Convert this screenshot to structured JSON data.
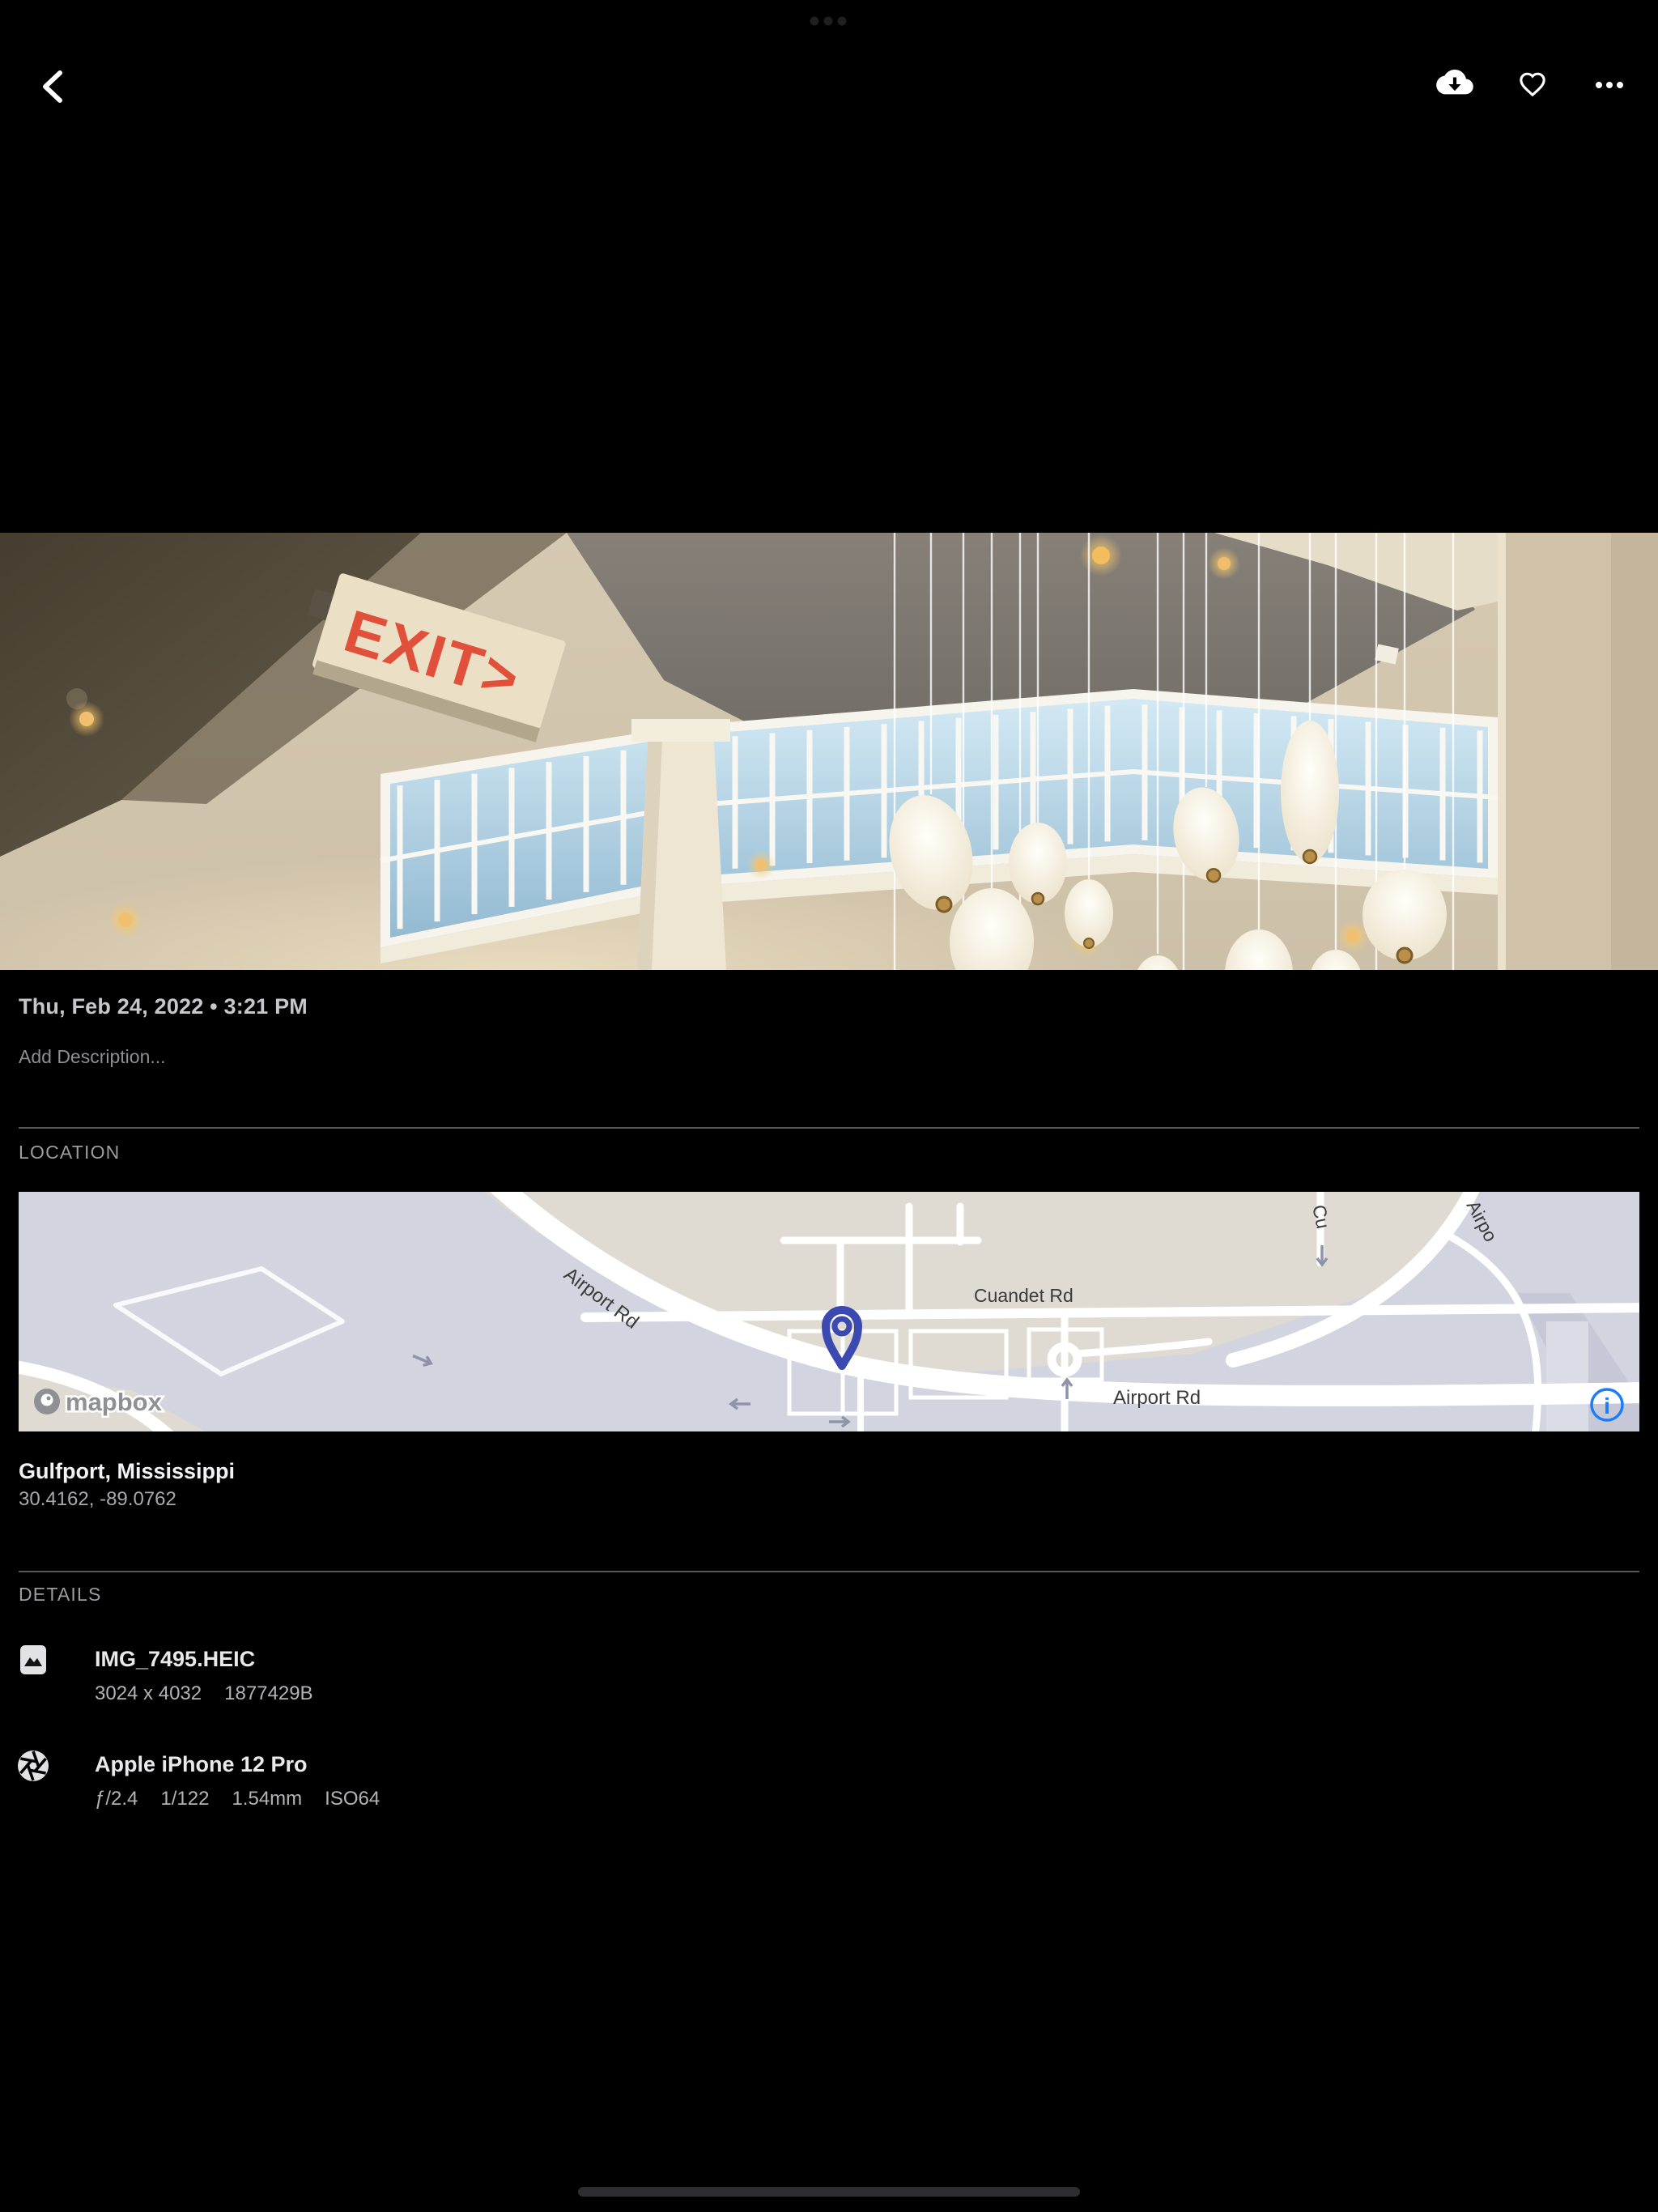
{
  "colors": {
    "background": "#000000",
    "info_blue": "#1d7df6",
    "pin_indigo": "#3a4ab0",
    "exit_red": "#e0503a",
    "map_land": "#dfdbd2",
    "map_water": "#d2d4e0"
  },
  "photo": {
    "exit_sign_text": "EXIT>"
  },
  "info": {
    "datetime": "Thu, Feb 24, 2022 • 3:21 PM",
    "description_placeholder": "Add Description..."
  },
  "location": {
    "header": "LOCATION",
    "place": "Gulfport, Mississippi",
    "coordinates": "30.4162, -89.0762",
    "map": {
      "labels": {
        "airport_rd_upper": "Airport Rd",
        "cuandet_rd": "Cuandet Rd",
        "airport_rd_lower": "Airport Rd",
        "partial_cu": "Cu",
        "partial_airpo": "Airpo"
      },
      "attribution": "mapbox",
      "info_glyph": "i"
    }
  },
  "details": {
    "header": "DETAILS",
    "files": [
      {
        "icon": "image-icon",
        "title": "IMG_7495.HEIC",
        "meta": [
          "3024 x 4032",
          "1877429B"
        ]
      },
      {
        "icon": "aperture-icon",
        "title": "Apple iPhone 12 Pro",
        "meta": [
          "ƒ/2.4",
          "1/122",
          "1.54mm",
          "ISO64"
        ]
      }
    ]
  }
}
